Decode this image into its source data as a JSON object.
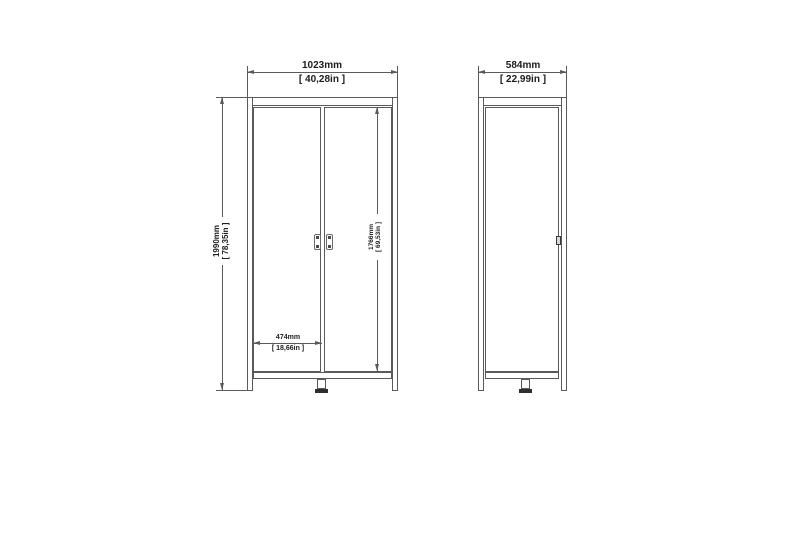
{
  "colors": {
    "line": "#5a5a5a",
    "line_dark": "#2f2f2f",
    "text": "#1c1c1c",
    "background": "#ffffff"
  },
  "front_view": {
    "width": {
      "mm": "1023mm",
      "inches": "[ 40,28in ]"
    },
    "height": {
      "mm": "1990mm",
      "inches": "[ 78,35in ]"
    },
    "door_height": {
      "mm": "1766mm",
      "inches": "[ 69,53in ]"
    },
    "door_width": {
      "mm": "474mm",
      "inches": "[ 18,66in ]"
    }
  },
  "side_view": {
    "depth": {
      "mm": "584mm",
      "inches": "[ 22,99in ]"
    }
  }
}
